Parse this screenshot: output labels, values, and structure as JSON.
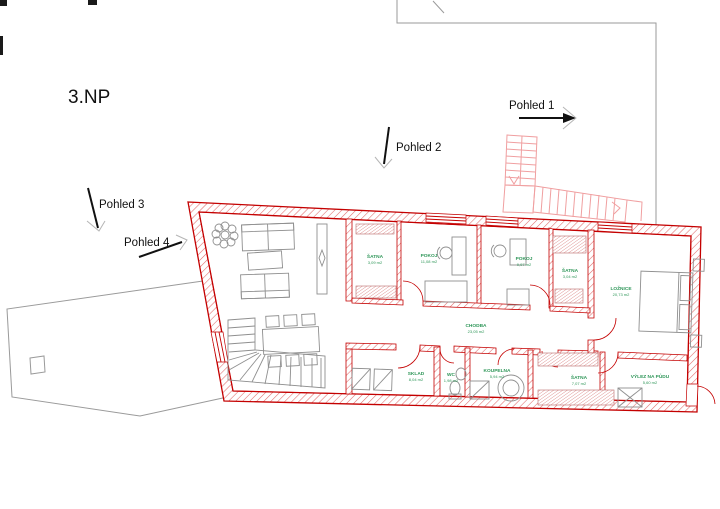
{
  "title": "3.NP",
  "views": [
    {
      "label": "Pohled 1"
    },
    {
      "label": "Pohled 2"
    },
    {
      "label": "Pohled 3"
    },
    {
      "label": "Pohled 4"
    }
  ],
  "rooms": [
    {
      "name": "ŠATNA",
      "area": "3,09 m2"
    },
    {
      "name": "POKOJ",
      "area": "11,08 m2"
    },
    {
      "name": "POKOJ",
      "area": "9,97 m2"
    },
    {
      "name": "ŠATNA",
      "area": "3,04 m2"
    },
    {
      "name": "LOŽNICE",
      "area": "20,73 m2"
    },
    {
      "name": "CHODBA",
      "area": "23,05 m2"
    },
    {
      "name": "SKLAD",
      "area": "8,04 m2"
    },
    {
      "name": "WC",
      "area": "1,98 m2"
    },
    {
      "name": "KOUPELNA",
      "area": "5,94 m2"
    },
    {
      "name": "ŠATNA",
      "area": "7,07 m2"
    },
    {
      "name": "VÝLEZ NA PŮDU",
      "area": "5,60 m2"
    }
  ],
  "colors": {
    "wall_red": "#c40000",
    "hatch_red": "#e06a6a",
    "label_green": "#2e9658",
    "stair_pink": "#f09fa0",
    "outline_gray": "#9a9a9a"
  }
}
